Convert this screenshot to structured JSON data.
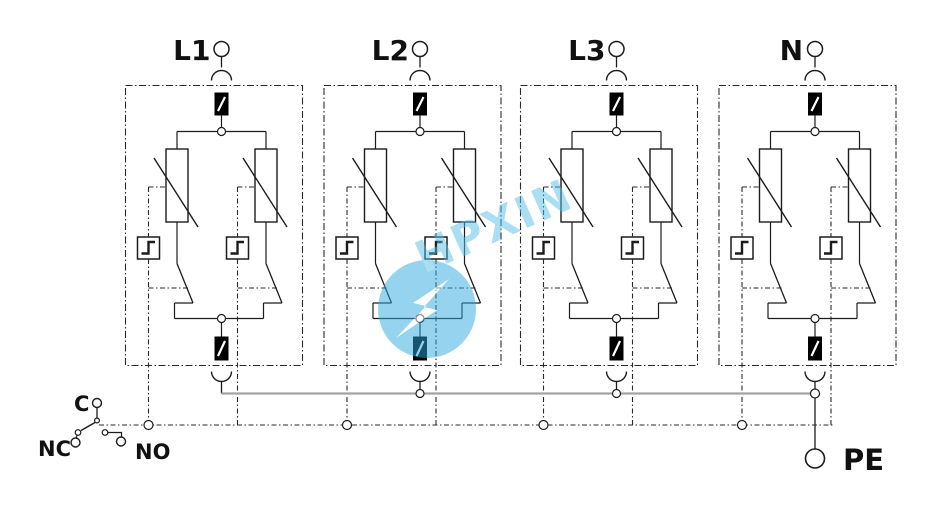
{
  "terminals": {
    "phases": [
      {
        "label": "L1"
      },
      {
        "label": "L2"
      },
      {
        "label": "L3"
      },
      {
        "label": "N"
      }
    ],
    "earth": {
      "label": "PE"
    }
  },
  "remote_signal_contact": {
    "common": "C",
    "nc": "NC",
    "no": "NO"
  },
  "watermark": {
    "text": "HPXIN",
    "logo_icon": "lightning-bolt-icon",
    "text_color": "#55bfe9",
    "logo_color": "#2fa9de"
  },
  "colors": {
    "wire": "#1c1c1c",
    "module_border": "#2a2a2a",
    "pe_bus_gray": "#a3a3a3",
    "fuse_fill": "#000000",
    "background": "#ffffff"
  }
}
